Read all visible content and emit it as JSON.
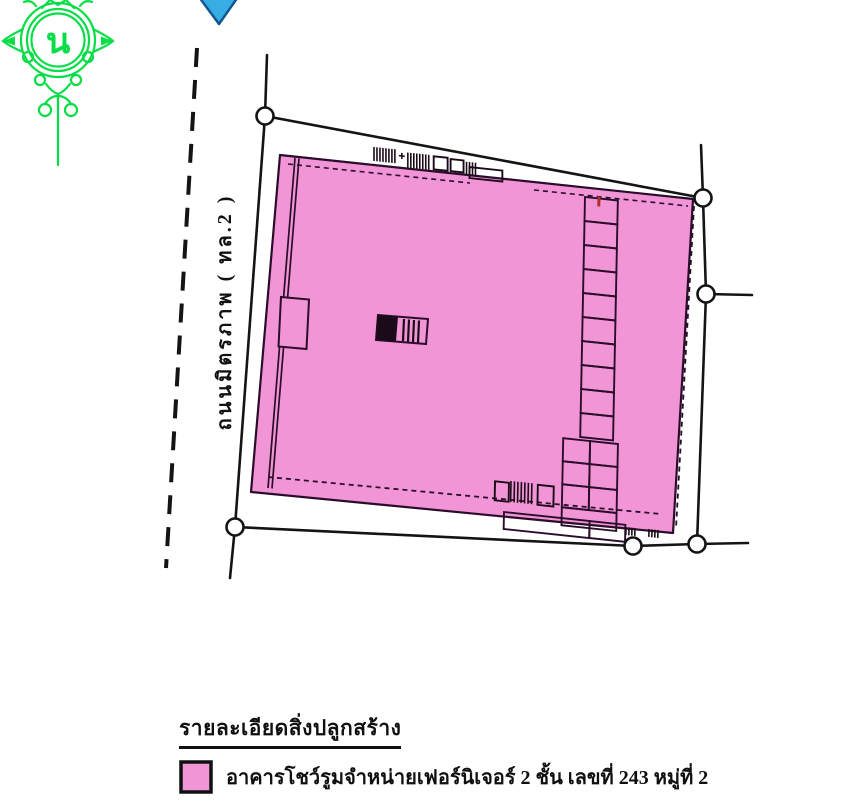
{
  "page": {
    "background": "#ffffff",
    "type": "land-plot-building-sketch"
  },
  "seal": {
    "description": "green ornamental official seal with Thai letter",
    "letter": "น",
    "color": "#08dd48"
  },
  "north_arrow": {
    "shape": "downward-triangle",
    "fill": "#38ade4",
    "stroke": "#14578f"
  },
  "road": {
    "label": "ถนนมิตรภาพ ( ทล.2 )",
    "line_style": "dashed-centerline"
  },
  "plot": {
    "fill": "#f295d7",
    "outline_color": "#151515",
    "wall_color": "#2b0d2b",
    "survey_marker_count": 6,
    "building": "showroom footprint with room partitions along east side, stairs, and service structures"
  },
  "legend": {
    "title": "รายละเอียดสิ่งปลูกสร้าง",
    "items": [
      {
        "swatch_color": "#f295d7",
        "label": "อาคารโชว์รูมจำหน่ายเฟอร์นิเจอร์ 2 ชั้น เลขที่ 243 หมู่ที่ 2"
      }
    ]
  }
}
